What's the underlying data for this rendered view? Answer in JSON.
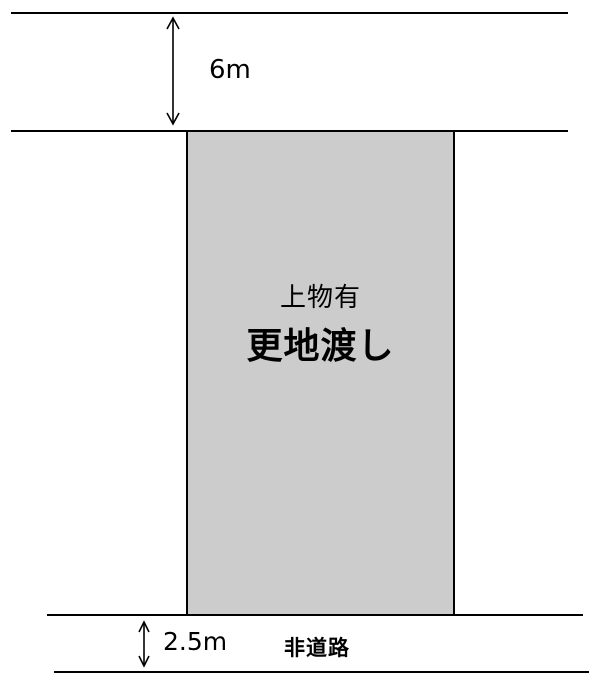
{
  "diagram": {
    "title_implied": "land-parcel-diagram",
    "colors": {
      "background": "#ffffff",
      "line": "#000000",
      "parcel_fill": "#cccccc",
      "text": "#000000"
    },
    "top_road": {
      "width_label": "6m"
    },
    "parcel": {
      "note_label": "上物有",
      "main_label": "更地渡し"
    },
    "bottom_road": {
      "width_label": "2.5m",
      "type_label": "非道路"
    },
    "icons": {
      "top_dimension_arrow": "double-headed-vertical-arrow",
      "bottom_dimension_arrow": "double-headed-vertical-arrow"
    }
  }
}
